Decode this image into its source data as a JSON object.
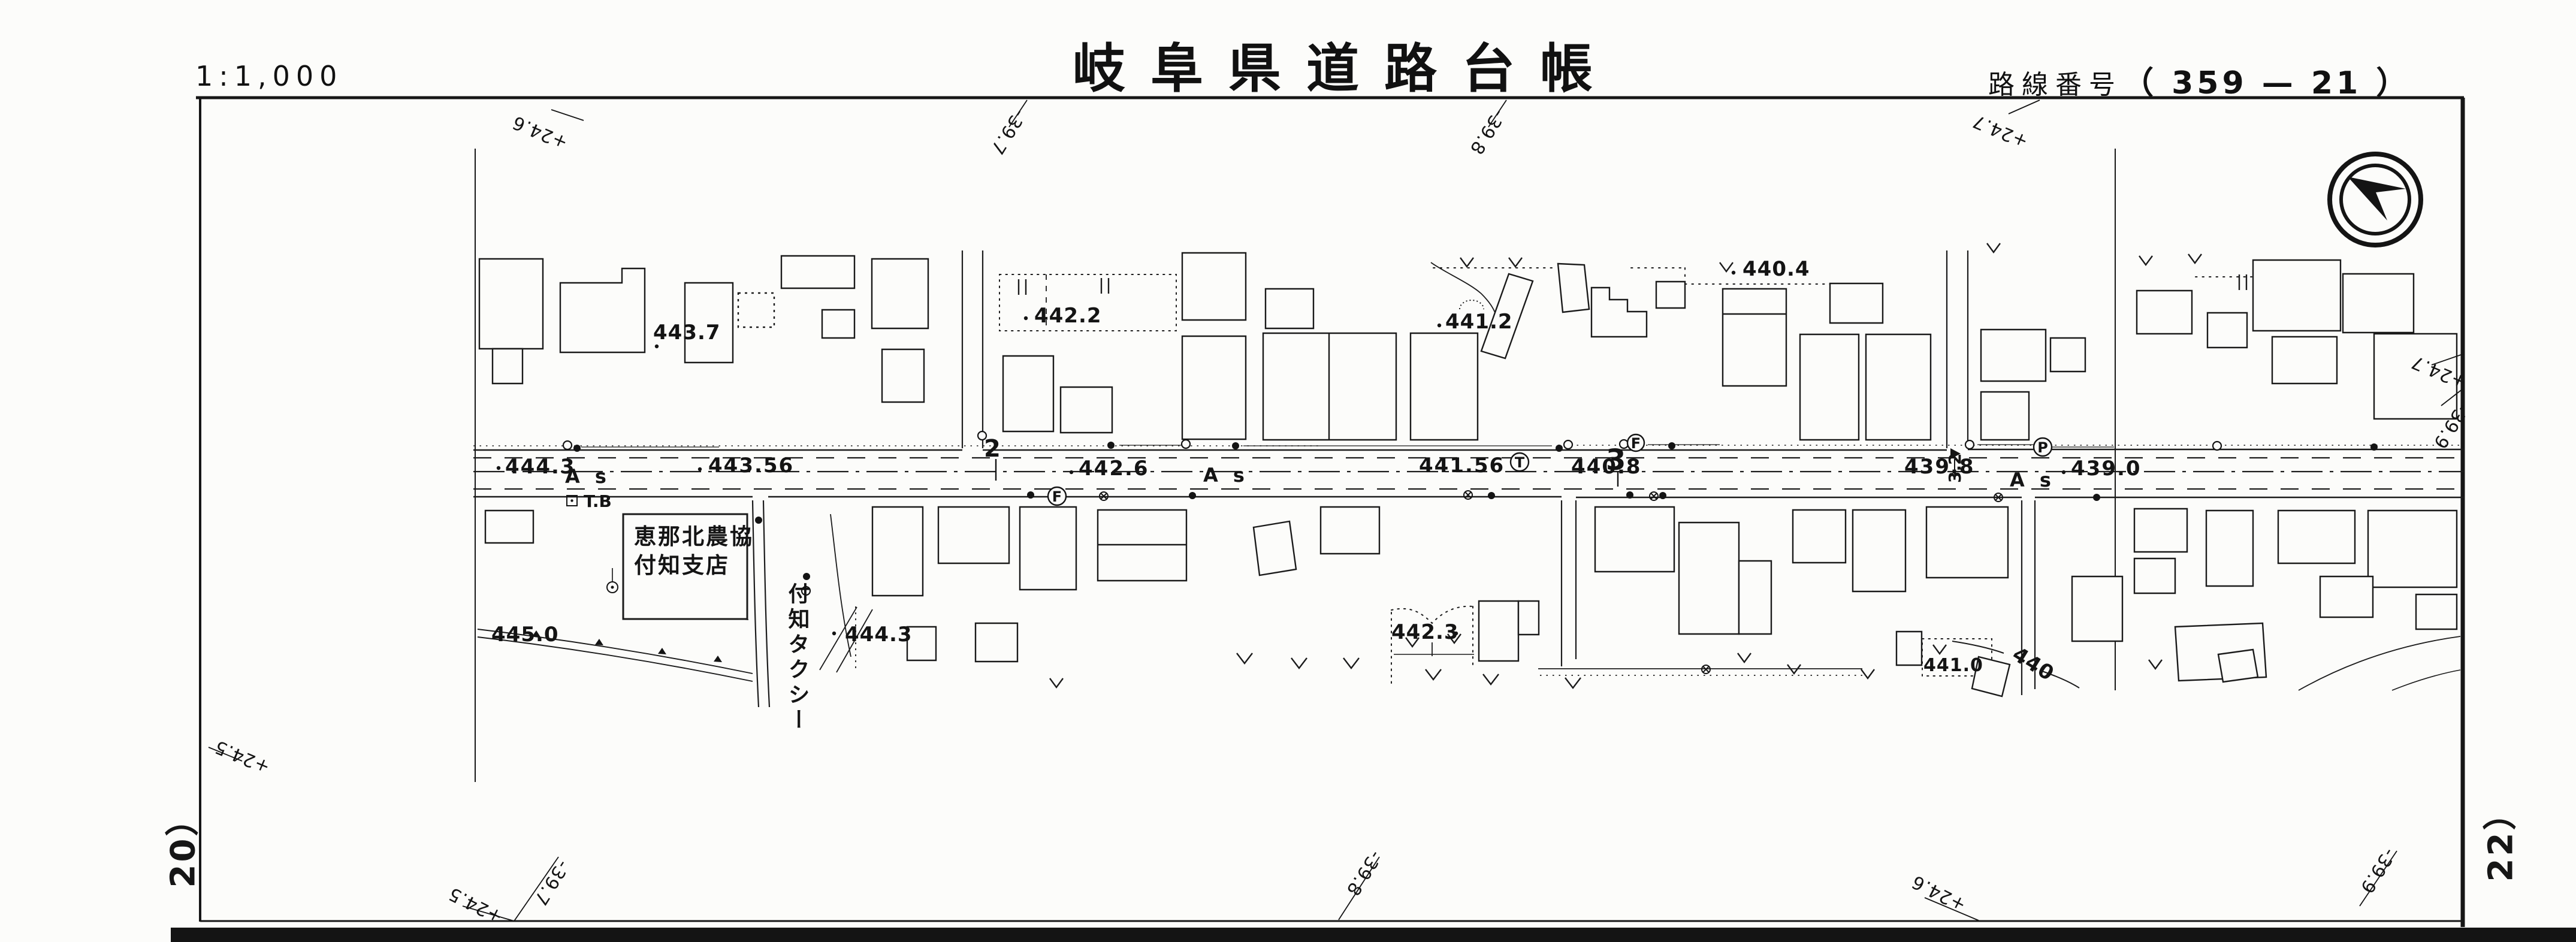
{
  "header": {
    "scale": "1:1,000",
    "title": "岐阜県道路台帳",
    "route_label": "路線番号",
    "route_value": "（ 359 — 21 ）"
  },
  "sheet_refs": {
    "left": "20）",
    "right": "22）"
  },
  "map": {
    "road": {
      "elevations": [
        "444.3",
        "443.56",
        "442.6",
        "441.56",
        "440.8",
        "439.8",
        "439.0"
      ],
      "stations": [
        "2",
        "3"
      ],
      "surface": "A s",
      "pole_letters": [
        "F",
        "T",
        "F",
        "P"
      ],
      "bench": "T.B",
      "width_note": "3.2"
    },
    "spots": [
      "443.7",
      "442.2",
      "441.2",
      "440.4",
      "445.0",
      "444.3",
      "442.3",
      "441.0"
    ],
    "contour": "440",
    "grid": [
      "+24.6",
      "-39.7",
      "-39.8",
      "+24.7",
      "+24.7",
      "-39.9",
      "+24.5",
      "+24.5",
      "-39.7",
      "-39.8",
      "+24.6",
      "-39.9"
    ],
    "buildings": {
      "ja_line1": "恵那北農協",
      "ja_line2": "付知支店",
      "taxi": "付知タクシー"
    }
  }
}
